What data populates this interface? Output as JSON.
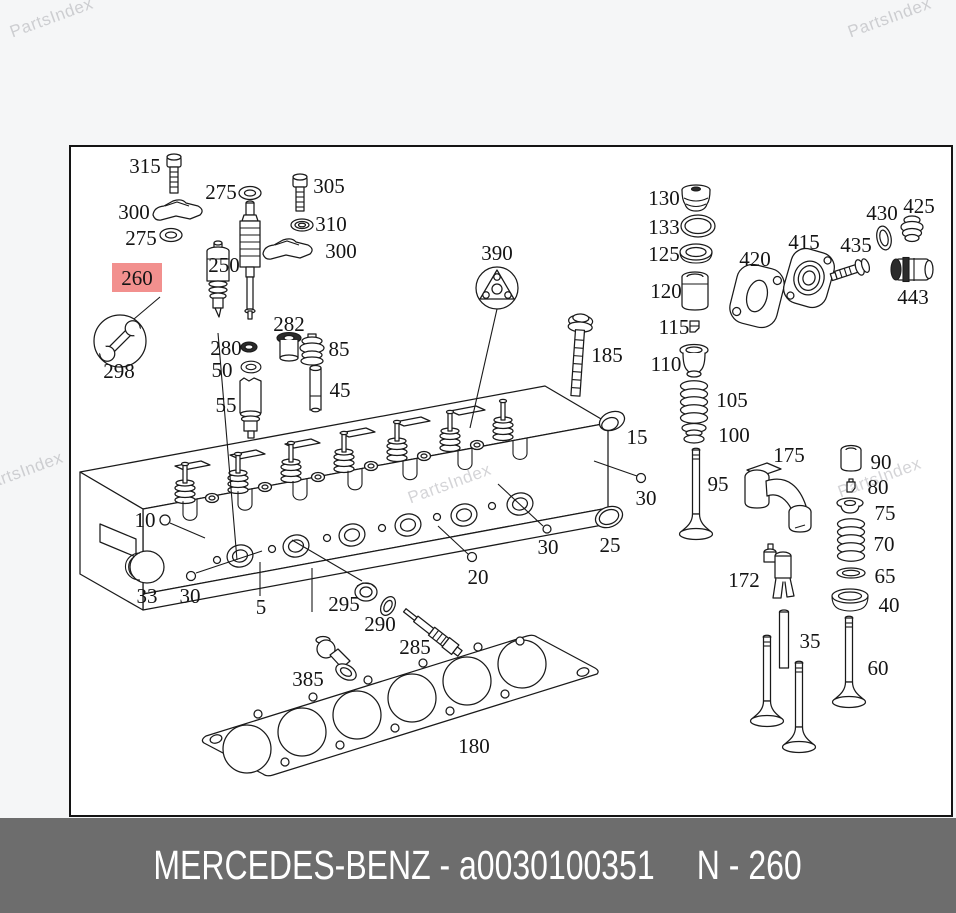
{
  "watermark": {
    "text": "PartsIndex",
    "color": "#d2d2d6",
    "positions": [
      {
        "x": 8,
        "y": 8
      },
      {
        "x": 846,
        "y": 8
      },
      {
        "x": -22,
        "y": 462
      },
      {
        "x": 406,
        "y": 474
      },
      {
        "x": 836,
        "y": 468
      }
    ]
  },
  "footer": {
    "brand_part": "MERCEDES-BENZ - a0030100351",
    "ref": "N - 260",
    "bg": "#6d6d6d",
    "text_color": "#ffffff"
  },
  "diagram": {
    "ink": "#141414",
    "highlight": {
      "label": "260",
      "bg": "#f2908e",
      "text_color": "#bf3430"
    },
    "labels": [
      {
        "t": "315",
        "x": 145,
        "y": 166
      },
      {
        "t": "300",
        "x": 134,
        "y": 212
      },
      {
        "t": "275",
        "x": 141,
        "y": 238
      },
      {
        "t": "260",
        "x": 137,
        "y": 278,
        "hl": true
      },
      {
        "t": "298",
        "x": 119,
        "y": 371
      },
      {
        "t": "275",
        "x": 221,
        "y": 192
      },
      {
        "t": "250",
        "x": 224,
        "y": 265
      },
      {
        "t": "305",
        "x": 329,
        "y": 186
      },
      {
        "t": "310",
        "x": 331,
        "y": 224
      },
      {
        "t": "300",
        "x": 341,
        "y": 251
      },
      {
        "t": "282",
        "x": 289,
        "y": 324
      },
      {
        "t": "280",
        "x": 226,
        "y": 348
      },
      {
        "t": "50",
        "x": 222,
        "y": 370
      },
      {
        "t": "55",
        "x": 226,
        "y": 405
      },
      {
        "t": "85",
        "x": 339,
        "y": 349
      },
      {
        "t": "45",
        "x": 340,
        "y": 390
      },
      {
        "t": "390",
        "x": 497,
        "y": 253
      },
      {
        "t": "185",
        "x": 607,
        "y": 355
      },
      {
        "t": "130",
        "x": 664,
        "y": 198
      },
      {
        "t": "133",
        "x": 664,
        "y": 227
      },
      {
        "t": "125",
        "x": 664,
        "y": 254
      },
      {
        "t": "120",
        "x": 666,
        "y": 291
      },
      {
        "t": "115",
        "x": 674,
        "y": 327
      },
      {
        "t": "110",
        "x": 666,
        "y": 364
      },
      {
        "t": "105",
        "x": 732,
        "y": 400
      },
      {
        "t": "100",
        "x": 734,
        "y": 435
      },
      {
        "t": "95",
        "x": 718,
        "y": 484
      },
      {
        "t": "175",
        "x": 789,
        "y": 455
      },
      {
        "t": "172",
        "x": 744,
        "y": 580
      },
      {
        "t": "90",
        "x": 881,
        "y": 462
      },
      {
        "t": "80",
        "x": 878,
        "y": 487
      },
      {
        "t": "75",
        "x": 885,
        "y": 513
      },
      {
        "t": "70",
        "x": 884,
        "y": 544
      },
      {
        "t": "65",
        "x": 885,
        "y": 576
      },
      {
        "t": "40",
        "x": 889,
        "y": 605
      },
      {
        "t": "35",
        "x": 810,
        "y": 641
      },
      {
        "t": "60",
        "x": 878,
        "y": 668
      },
      {
        "t": "420",
        "x": 755,
        "y": 259
      },
      {
        "t": "415",
        "x": 804,
        "y": 242
      },
      {
        "t": "435",
        "x": 856,
        "y": 245
      },
      {
        "t": "430",
        "x": 882,
        "y": 213
      },
      {
        "t": "425",
        "x": 919,
        "y": 206
      },
      {
        "t": "443",
        "x": 913,
        "y": 297
      },
      {
        "t": "15",
        "x": 637,
        "y": 437
      },
      {
        "t": "30",
        "x": 646,
        "y": 498
      },
      {
        "t": "25",
        "x": 610,
        "y": 545
      },
      {
        "t": "30",
        "x": 548,
        "y": 547
      },
      {
        "t": "20",
        "x": 478,
        "y": 577
      },
      {
        "t": "10",
        "x": 145,
        "y": 520
      },
      {
        "t": "33",
        "x": 147,
        "y": 596
      },
      {
        "t": "30",
        "x": 190,
        "y": 596
      },
      {
        "t": "5",
        "x": 261,
        "y": 607
      },
      {
        "t": "295",
        "x": 344,
        "y": 604
      },
      {
        "t": "290",
        "x": 380,
        "y": 624
      },
      {
        "t": "285",
        "x": 415,
        "y": 647
      },
      {
        "t": "385",
        "x": 308,
        "y": 679
      },
      {
        "t": "180",
        "x": 474,
        "y": 746
      }
    ]
  }
}
